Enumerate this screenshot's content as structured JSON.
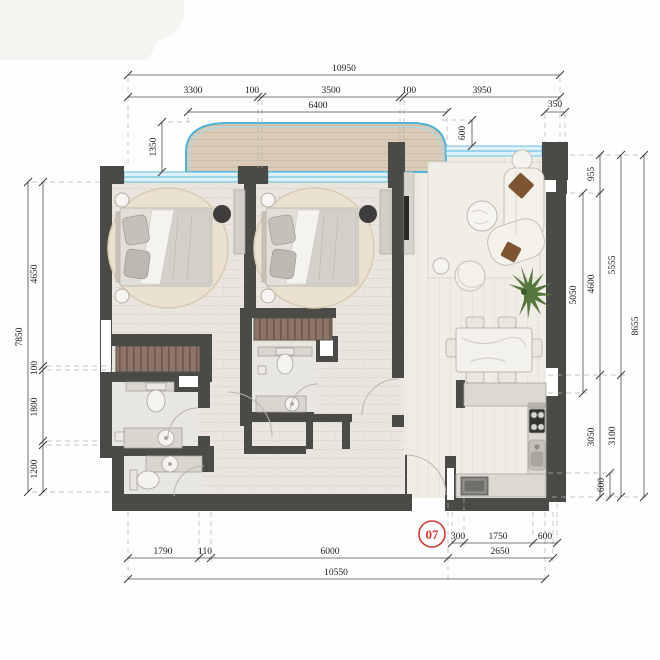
{
  "unit": {
    "number": "07"
  },
  "dims": {
    "top": {
      "total": "10950",
      "seg1": "3300",
      "seg2": "100",
      "seg3": "3500",
      "seg4": "100",
      "seg5": "3950",
      "balcony": "6400",
      "corner": "350",
      "depth": "1350",
      "offset": "600"
    },
    "left": {
      "total": "7850",
      "seg1": "4650",
      "seg2": "100",
      "seg3": "1800",
      "seg4": "1200"
    },
    "right": {
      "total": "8655",
      "living": "5050",
      "seg1": "955",
      "seg2": "4600",
      "seg3": "3050",
      "mini": "600",
      "seg4": "5555",
      "seg5": "3100"
    },
    "bottom": {
      "total": "10550",
      "seg1": "1790",
      "seg2": "110",
      "seg3": "6000",
      "seg4": "300",
      "seg5": "1750",
      "seg6": "600",
      "seg7": "2650"
    }
  },
  "colors": {
    "wall": "#4a4a47",
    "glazing": "#55b7d8",
    "accent_red": "#cf3a30",
    "wood": "#8d7567"
  }
}
